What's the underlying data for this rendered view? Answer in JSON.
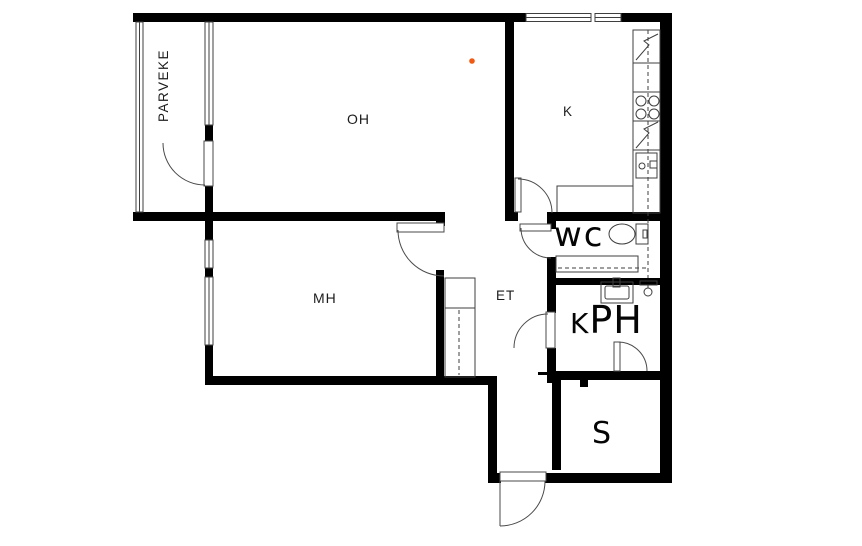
{
  "title": "Apartment floor plan",
  "rooms": {
    "parveke": {
      "label": "PARVEKE"
    },
    "oh": {
      "label": "OH"
    },
    "k": {
      "label": "K"
    },
    "mh": {
      "label": "MH"
    },
    "et": {
      "label": "ET"
    },
    "wc": {
      "label": "WC"
    },
    "kph": {
      "label": "KPH"
    },
    "s": {
      "label": "S"
    }
  },
  "annotations": {
    "marker_dot_color": "#f05a14"
  },
  "colors": {
    "wall": "#000000",
    "thin_line": "#3f3f3f",
    "background": "#ffffff"
  },
  "symbols": [
    "toilet-symbol",
    "sink-symbol",
    "shower-symbol",
    "stove-symbol",
    "fridge-symbol",
    "dishwasher-symbol",
    "kitchen-sink-symbol",
    "wardrobe-symbol",
    "door-arc",
    "window-symbol"
  ]
}
